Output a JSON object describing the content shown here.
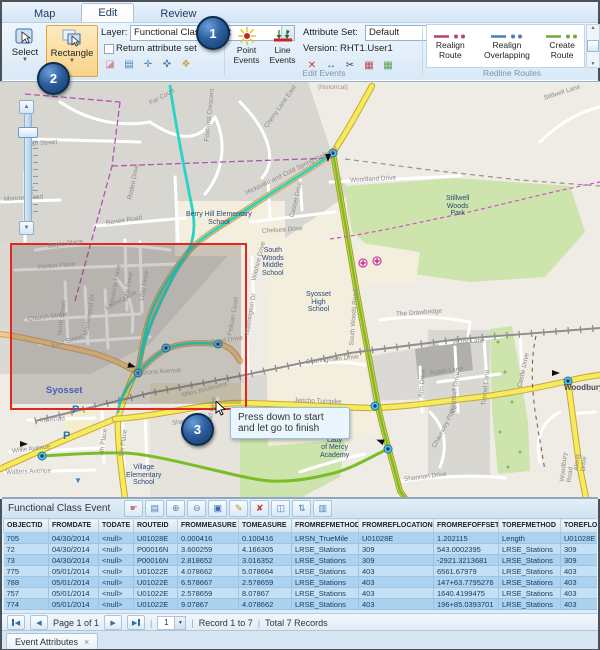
{
  "ribbon": {
    "tabs": [
      {
        "label": "Map"
      },
      {
        "label": "Edit"
      },
      {
        "label": "Review"
      }
    ],
    "selection_group": {
      "label": "Selection",
      "select_button": "Select",
      "rectangle_button": "Rectangle",
      "layer_label": "Layer:",
      "layer_value": "Functional Class Event",
      "return_attribute_set": "Return attribute set",
      "mini_icons": [
        "eraser-icon",
        "attribute-list-icon",
        "select-point-icon",
        "select-line-icon",
        "select-polygon-icon"
      ]
    },
    "edit_events_group": {
      "label": "Edit Events",
      "point_events": "Point Events",
      "line_events": "Line Events",
      "attribute_set_label": "Attribute Set:",
      "attribute_set_value": "Default",
      "version_text": "Version: RHT1.User1",
      "mini_icons": [
        "split-event-icon",
        "merge-events-icon",
        "trim-event-icon",
        "event-table-icon",
        "attribute-grid-icon"
      ]
    },
    "redline_group": {
      "label": "Redline Routes",
      "buttons": [
        {
          "label": "Realign Route",
          "color": "#b5446a"
        },
        {
          "label": "Realign Overlapping",
          "color": "#4a7fb5"
        },
        {
          "label": "Create Route",
          "color": "#6faa3c"
        }
      ]
    }
  },
  "callouts": [
    {
      "n": "1"
    },
    {
      "n": "2"
    },
    {
      "n": "3"
    }
  ],
  "map": {
    "tooltip": "Press down to start and let go to finish",
    "parking_letter": "P",
    "labels": [
      {
        "t": "Baylis Place",
        "x": 48,
        "y": 243,
        "r": -8
      },
      {
        "t": "Horton Place",
        "x": 38,
        "y": 264,
        "r": -5
      },
      {
        "t": "Church Street",
        "x": 28,
        "y": 316,
        "r": -7
      },
      {
        "t": "North Street",
        "x": 60,
        "y": 332,
        "r": -83
      },
      {
        "t": "East Street",
        "x": 52,
        "y": 343,
        "r": -18
      },
      {
        "t": "Maplewood Dr",
        "x": 86,
        "y": 332,
        "r": -80
      },
      {
        "t": "Wisteria Place",
        "x": 112,
        "y": 302,
        "r": -80
      },
      {
        "t": "Tulip Drive",
        "x": 126,
        "y": 299,
        "r": -80
      },
      {
        "t": "Lilac Drive",
        "x": 142,
        "y": 297,
        "r": -80
      },
      {
        "t": "Laurel Lane",
        "x": 106,
        "y": 305,
        "r": -28
      },
      {
        "t": "Arizona Avenue",
        "x": 136,
        "y": 370,
        "r": -4
      },
      {
        "t": "Miles Boulevard",
        "x": 182,
        "y": 392,
        "r": -14
      },
      {
        "t": "Ira Road",
        "x": 40,
        "y": 417,
        "r": -4
      },
      {
        "t": "Willis Avenue",
        "x": 12,
        "y": 448,
        "r": -7
      },
      {
        "t": "Walters Avenue",
        "x": 6,
        "y": 469,
        "r": -2
      },
      {
        "t": "4th Place",
        "x": 102,
        "y": 452,
        "r": -83
      },
      {
        "t": "5th Place",
        "x": 122,
        "y": 453,
        "r": -83
      },
      {
        "t": "Sherman",
        "x": 172,
        "y": 420,
        "r": -8
      },
      {
        "t": "Ronald Lane",
        "x": 208,
        "y": 430,
        "r": -80
      },
      {
        "t": "Renee Road",
        "x": 106,
        "y": 220,
        "r": -9
      },
      {
        "t": "Rodeo Drive",
        "x": 130,
        "y": 196,
        "r": -78
      },
      {
        "t": "Far Court",
        "x": 150,
        "y": 100,
        "r": -28
      },
      {
        "t": "Foxhurst Crescent",
        "x": 207,
        "y": 138,
        "r": -84
      },
      {
        "t": "Ivan Street",
        "x": 26,
        "y": 141,
        "r": -4
      },
      {
        "t": "Clifton Street",
        "x": 28,
        "y": 220,
        "r": -84
      },
      {
        "t": "Monroe Road",
        "x": 4,
        "y": 196,
        "r": -4
      },
      {
        "t": "Cherry Lane East",
        "x": 266,
        "y": 124,
        "r": -55
      },
      {
        "t": "Stillwell Lane",
        "x": 544,
        "y": 95,
        "r": -18
      },
      {
        "t": "Woodland Drive",
        "x": 350,
        "y": 177,
        "r": -3
      },
      {
        "t": "Chelsea Drive",
        "x": 262,
        "y": 228,
        "r": -4
      },
      {
        "t": "Casset Drive",
        "x": 292,
        "y": 214,
        "r": -76
      },
      {
        "t": "Wilshire Drive",
        "x": 254,
        "y": 277,
        "r": -76
      },
      {
        "t": "Washington Dr",
        "x": 247,
        "y": 332,
        "r": -80
      },
      {
        "t": "Searingtown Drive",
        "x": 306,
        "y": 359,
        "r": -6
      },
      {
        "t": "The Drawbridge",
        "x": 396,
        "y": 311,
        "r": -4
      },
      {
        "t": "Victor Lane",
        "x": 452,
        "y": 339,
        "r": -3
      },
      {
        "t": "Rubin Lane",
        "x": 430,
        "y": 370,
        "r": -8
      },
      {
        "t": "Wagstaff Drive",
        "x": 452,
        "y": 410,
        "r": -82
      },
      {
        "t": "Tunnel Lane",
        "x": 484,
        "y": 402,
        "r": -84
      },
      {
        "t": "Castle Drive",
        "x": 520,
        "y": 384,
        "r": -78
      },
      {
        "t": "Along Drive",
        "x": 580,
        "y": 464,
        "r": -84
      },
      {
        "t": "Woodbury Road",
        "x": 566,
        "y": 475,
        "r": -84
      },
      {
        "t": "Ann Drive",
        "x": 421,
        "y": 394,
        "r": -84
      },
      {
        "t": "Chauncey Place",
        "x": 434,
        "y": 444,
        "r": -62
      },
      {
        "t": "Shannon Drive",
        "x": 404,
        "y": 476,
        "r": -7
      },
      {
        "t": "Jericho Turnpike",
        "x": 294,
        "y": 397,
        "r": 2
      },
      {
        "t": "South Woods Road",
        "x": 352,
        "y": 342,
        "r": -86
      },
      {
        "t": "Hicksville and Cold Spring Railroad",
        "x": 246,
        "y": 190,
        "r": -26
      },
      {
        "t": "(historical)",
        "x": 318,
        "y": 84,
        "r": 0,
        "c": "hist"
      },
      {
        "t": "Bond Drive",
        "x": 211,
        "y": 339,
        "r": -8
      },
      {
        "t": "Pelican Court",
        "x": 230,
        "y": 332,
        "r": -80
      },
      {
        "t": "Syosset",
        "x": 46,
        "y": 386,
        "r": 0,
        "c": "town"
      },
      {
        "t": "Woodbury",
        "x": 564,
        "y": 384,
        "r": 0,
        "c": "town2"
      },
      {
        "t": "Berry Hill Elementary\nSchool",
        "x": 186,
        "y": 211,
        "r": 0,
        "c": "place"
      },
      {
        "t": "South\nWoods\nMiddle\nSchool",
        "x": 262,
        "y": 247,
        "r": 0,
        "c": "place"
      },
      {
        "t": "Syosset\nHigh\nSchool",
        "x": 306,
        "y": 291,
        "r": 0,
        "c": "place"
      },
      {
        "t": "Stillwell\nWoods\nPark",
        "x": 446,
        "y": 195,
        "r": 0,
        "c": "place"
      },
      {
        "t": "Our\nLady\nof Mercy\nAcademy",
        "x": 320,
        "y": 429,
        "r": 0,
        "c": "place"
      },
      {
        "t": "Village\nElementary\nSchool",
        "x": 126,
        "y": 464,
        "r": 0,
        "c": "place"
      }
    ]
  },
  "table": {
    "title": "Functional Class Event",
    "toolbar_icons": [
      "select-records-icon",
      "clear-selection-icon",
      "zoom-to-selection-icon",
      "pan-to-selection-icon",
      "save-icon",
      "edit-records-icon",
      "delete-records-icon",
      "related-records-icon",
      "sort-records-icon",
      "export-records-icon"
    ],
    "columns": [
      "OBJECTID",
      "FROMDATE",
      "TODATE",
      "ROUTEID",
      "FROMMEASURE",
      "TOMEASURE",
      "FROMREFMETHOD",
      "FROMREFLOCATION",
      "FROMREFOFFSET",
      "TOREFMETHOD",
      "TOREFLOCATION",
      "TOREFOFFSET"
    ],
    "rows": [
      [
        "705",
        "04/30/2014",
        "<null>",
        "U01028E",
        "0.000416",
        "0.100416",
        "LRSN_TrueMile",
        "U01028E",
        "1.202115",
        "Length",
        "U01028E",
        "328.0839895"
      ],
      [
        "72",
        "04/30/2014",
        "<null>",
        "P00016N",
        "3.600259",
        "4.166305",
        "LRSE_Stations",
        "309",
        "543.0002395",
        "LRSE_Stations",
        "309",
        "2400.1048819"
      ],
      [
        "73",
        "04/30/2014",
        "<null>",
        "P00016N",
        "2.818652",
        "3.016352",
        "LRSE_Stations",
        "309",
        "-2921.3213681",
        "LRSE_Stations",
        "309",
        "-1372.7007874"
      ],
      [
        "775",
        "05/01/2014",
        "<null>",
        "U01022E",
        "4.078662",
        "5.078664",
        "LRSE_Stations",
        "403",
        "6561.67979",
        "LRSE_Stations",
        "403",
        "9842.519685"
      ],
      [
        "788",
        "05/01/2014",
        "<null>",
        "U01022E",
        "6.578667",
        "2.578659",
        "LRSE_Stations",
        "403",
        "147+63.7795276",
        "LRSE_Stations",
        "403",
        "1640.4199475"
      ],
      [
        "757",
        "05/01/2014",
        "<null>",
        "U01022E",
        "2.578659",
        "8.07867",
        "LRSE_Stations",
        "403",
        "1640.4199475",
        "LRSE_Stations",
        "403",
        "196+85.0393701"
      ],
      [
        "774",
        "05/01/2014",
        "<null>",
        "U01022E",
        "9.07867",
        "4.078662",
        "LRSE_Stations",
        "403",
        "196+85.0393701",
        "LRSE_Stations",
        "403",
        "6561.67979"
      ]
    ]
  },
  "pager": {
    "page_label": "Page 1 of 1",
    "page_value": "1",
    "records": "Record 1 to 7",
    "total": "Total 7 Records",
    "sep": "|"
  },
  "bottom_tab": {
    "label": "Event Attributes",
    "close": "×"
  }
}
